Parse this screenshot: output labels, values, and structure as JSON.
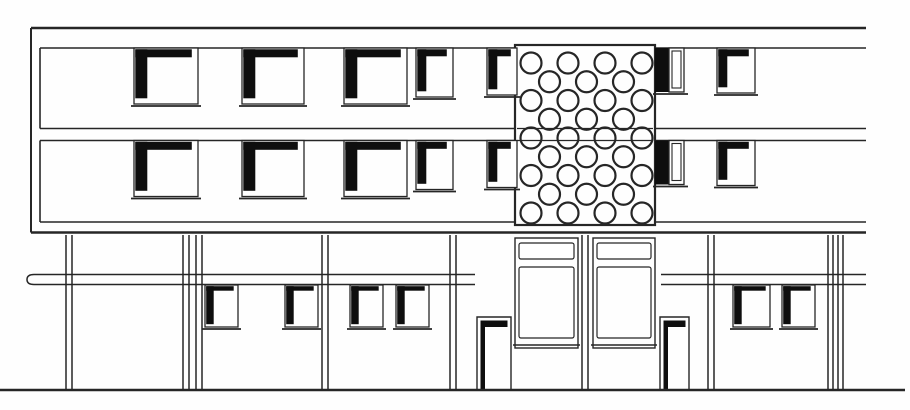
{
  "colors": {
    "ink": "#262626",
    "black": "#0e0e0e",
    "paper": "#fefefe"
  },
  "drawing": {
    "canvas": {
      "w": 910,
      "h": 410
    },
    "upper_volume": {
      "top_y": 28,
      "bottom_y": 232.5,
      "left_x": 31,
      "right_x": 866,
      "bands": [
        {
          "name": "upper-window-band",
          "top": 48,
          "bottom": 128.5,
          "left": 40,
          "right": 866
        },
        {
          "name": "lower-window-band",
          "top": 140.5,
          "bottom": 222,
          "left": 40,
          "right": 866
        }
      ],
      "window_columns": [
        {
          "x": 134,
          "w": 64,
          "h": 56,
          "kind": "large"
        },
        {
          "x": 242,
          "w": 62,
          "h": 56,
          "kind": "large"
        },
        {
          "x": 344,
          "w": 63,
          "h": 56,
          "kind": "large"
        },
        {
          "x": 416,
          "w": 37,
          "h": 49,
          "kind": "small"
        },
        {
          "x": 487,
          "w": 30,
          "h": 47,
          "kind": "small"
        },
        {
          "x": 655,
          "w": 29,
          "h": 44,
          "kind": "dark"
        },
        {
          "x": 717,
          "w": 38,
          "h": 45,
          "kind": "small"
        }
      ],
      "perforated_panel": {
        "x": 515,
        "y": 45,
        "w": 140,
        "h": 180,
        "rows": 9,
        "first_row_cy": 63,
        "row_spacing": 18.75,
        "even_row_cx": [
          531,
          568,
          605,
          642
        ],
        "odd_row_cx": [
          549.5,
          586.5,
          623.5
        ],
        "circle_r": 10.5,
        "floor_lines_y": [
          128.5,
          140.5
        ]
      }
    },
    "lower_level": {
      "top_y": 235,
      "ground_y": 390,
      "ground_x1": 0,
      "ground_x2": 905,
      "canopy_bands": [
        {
          "x1": 30,
          "x2": 475,
          "y1": 274.5,
          "y2": 284.5,
          "rounded_left": true
        },
        {
          "x1": 657,
          "x2": 866,
          "y1": 274.5,
          "y2": 284.5,
          "rounded_left": false
        }
      ],
      "columns_x": [
        66,
        72,
        183,
        189,
        196,
        202,
        322,
        328,
        450,
        456,
        582,
        588,
        708,
        714,
        828,
        833,
        838,
        843
      ],
      "windows": [
        {
          "x": 205,
          "w": 33
        },
        {
          "x": 285,
          "w": 33
        },
        {
          "x": 350,
          "w": 33
        },
        {
          "x": 396,
          "w": 33
        },
        {
          "x": 733,
          "w": 37
        },
        {
          "x": 782,
          "w": 33
        }
      ],
      "window_top": 285,
      "window_h": 42,
      "doors": [
        {
          "x": 477,
          "w": 34
        },
        {
          "x": 660,
          "w": 29
        }
      ],
      "door_top": 317,
      "glazed_panels": [
        {
          "x": 515,
          "w": 63
        },
        {
          "x": 593,
          "w": 62
        }
      ],
      "panel_top": 238,
      "panel_bottom": 348
    }
  }
}
